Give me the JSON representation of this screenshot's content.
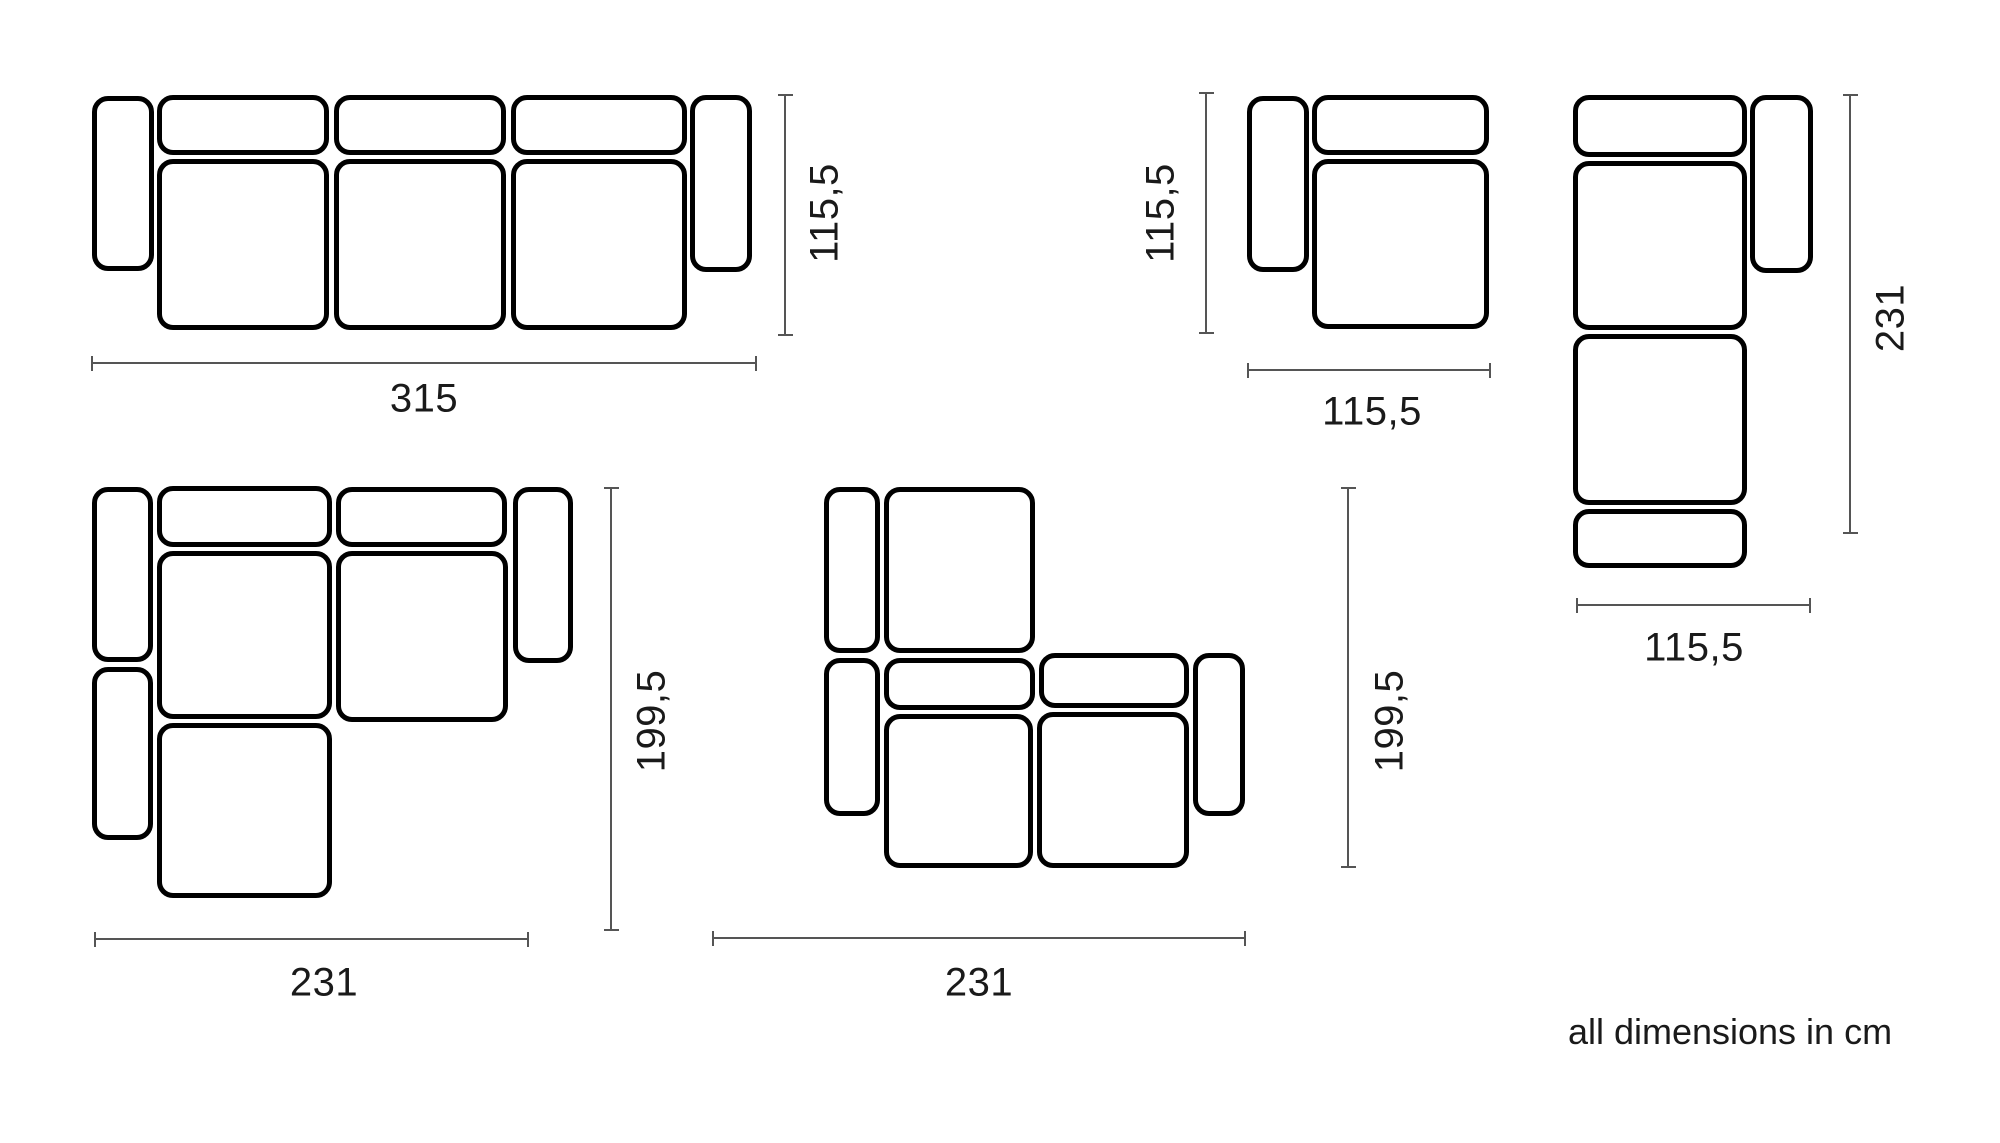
{
  "note": "all dimensions in cm",
  "colors": {
    "outline": "#000000",
    "dim_line": "#555555",
    "text": "#1a1a1a",
    "background": "#ffffff"
  },
  "diagrams": [
    {
      "id": "sofa-three-seater",
      "pieces": [
        {
          "name": "armrest-left",
          "x": 92,
          "y": 96,
          "w": 62,
          "h": 175
        },
        {
          "name": "backrest-1",
          "x": 157,
          "y": 95,
          "w": 172,
          "h": 60
        },
        {
          "name": "backrest-2",
          "x": 334,
          "y": 95,
          "w": 172,
          "h": 60
        },
        {
          "name": "backrest-3",
          "x": 511,
          "y": 95,
          "w": 176,
          "h": 60
        },
        {
          "name": "seat-1",
          "x": 157,
          "y": 159,
          "w": 172,
          "h": 171
        },
        {
          "name": "seat-2",
          "x": 334,
          "y": 159,
          "w": 172,
          "h": 171
        },
        {
          "name": "seat-3",
          "x": 511,
          "y": 159,
          "w": 176,
          "h": 171
        },
        {
          "name": "armrest-right",
          "x": 690,
          "y": 95,
          "w": 62,
          "h": 177
        }
      ],
      "dims": [
        {
          "type": "h",
          "x1": 92,
          "x2": 756,
          "y": 363,
          "label": "315",
          "lx": 424,
          "ly": 399
        },
        {
          "type": "v",
          "x": 785,
          "y1": 95,
          "y2": 335,
          "label": "115,5",
          "lx": 825,
          "ly": 213
        }
      ]
    },
    {
      "id": "sofa-single-module",
      "pieces": [
        {
          "name": "armrest-left",
          "x": 1247,
          "y": 96,
          "w": 62,
          "h": 176
        },
        {
          "name": "backrest",
          "x": 1312,
          "y": 95,
          "w": 177,
          "h": 60
        },
        {
          "name": "seat",
          "x": 1312,
          "y": 159,
          "w": 177,
          "h": 170
        }
      ],
      "dims": [
        {
          "type": "v",
          "x": 1206,
          "y1": 93,
          "y2": 333,
          "label": "115,5",
          "lx": 1161,
          "ly": 213
        },
        {
          "type": "h",
          "x1": 1248,
          "x2": 1490,
          "y": 370,
          "label": "115,5",
          "lx": 1372,
          "ly": 412
        }
      ]
    },
    {
      "id": "sofa-chaise-vertical",
      "pieces": [
        {
          "name": "backrest-top",
          "x": 1573,
          "y": 95,
          "w": 174,
          "h": 62
        },
        {
          "name": "armrest-right",
          "x": 1750,
          "y": 95,
          "w": 63,
          "h": 178
        },
        {
          "name": "seat-1",
          "x": 1573,
          "y": 161,
          "w": 174,
          "h": 169
        },
        {
          "name": "seat-2",
          "x": 1573,
          "y": 334,
          "w": 174,
          "h": 171
        },
        {
          "name": "end-bar",
          "x": 1573,
          "y": 509,
          "w": 174,
          "h": 59
        }
      ],
      "dims": [
        {
          "type": "v",
          "x": 1850,
          "y1": 95,
          "y2": 533,
          "label": "231",
          "lx": 1891,
          "ly": 318
        },
        {
          "type": "h",
          "x1": 1577,
          "x2": 1810,
          "y": 605,
          "label": "115,5",
          "lx": 1694,
          "ly": 648
        }
      ]
    },
    {
      "id": "corner-sofa-chaise-down",
      "pieces": [
        {
          "name": "armrest-top-left",
          "x": 92,
          "y": 487,
          "w": 61,
          "h": 175
        },
        {
          "name": "armrest-bottom-left",
          "x": 92,
          "y": 667,
          "w": 61,
          "h": 173
        },
        {
          "name": "backrest-1",
          "x": 157,
          "y": 486,
          "w": 175,
          "h": 61
        },
        {
          "name": "backrest-2",
          "x": 336,
          "y": 487,
          "w": 171,
          "h": 60
        },
        {
          "name": "seat-1",
          "x": 157,
          "y": 551,
          "w": 175,
          "h": 168
        },
        {
          "name": "seat-2",
          "x": 336,
          "y": 551,
          "w": 172,
          "h": 171
        },
        {
          "name": "armrest-right",
          "x": 513,
          "y": 487,
          "w": 60,
          "h": 176
        },
        {
          "name": "chaise-seat",
          "x": 157,
          "y": 723,
          "w": 175,
          "h": 175
        }
      ],
      "dims": [
        {
          "type": "v",
          "x": 611,
          "y1": 488,
          "y2": 930,
          "label": "199,5",
          "lx": 652,
          "ly": 721
        },
        {
          "type": "h",
          "x1": 95,
          "x2": 528,
          "y": 939,
          "label": "231",
          "lx": 324,
          "ly": 983
        }
      ]
    },
    {
      "id": "corner-sofa-chaise-up",
      "pieces": [
        {
          "name": "armrest-top-left",
          "x": 824,
          "y": 487,
          "w": 56,
          "h": 166
        },
        {
          "name": "chaise-seat",
          "x": 884,
          "y": 487,
          "w": 151,
          "h": 166
        },
        {
          "name": "armrest-mid-left",
          "x": 824,
          "y": 658,
          "w": 56,
          "h": 158
        },
        {
          "name": "backrest-1",
          "x": 884,
          "y": 658,
          "w": 151,
          "h": 52
        },
        {
          "name": "backrest-2",
          "x": 1039,
          "y": 653,
          "w": 150,
          "h": 55
        },
        {
          "name": "seat-1",
          "x": 884,
          "y": 714,
          "w": 149,
          "h": 154
        },
        {
          "name": "seat-2",
          "x": 1037,
          "y": 712,
          "w": 152,
          "h": 156
        },
        {
          "name": "armrest-right",
          "x": 1193,
          "y": 653,
          "w": 52,
          "h": 163
        }
      ],
      "dims": [
        {
          "type": "v",
          "x": 1348,
          "y1": 488,
          "y2": 867,
          "label": "199,5",
          "lx": 1390,
          "ly": 721
        },
        {
          "type": "h",
          "x1": 713,
          "x2": 1245,
          "y": 938,
          "label": "231",
          "lx": 979,
          "ly": 983
        }
      ]
    }
  ]
}
